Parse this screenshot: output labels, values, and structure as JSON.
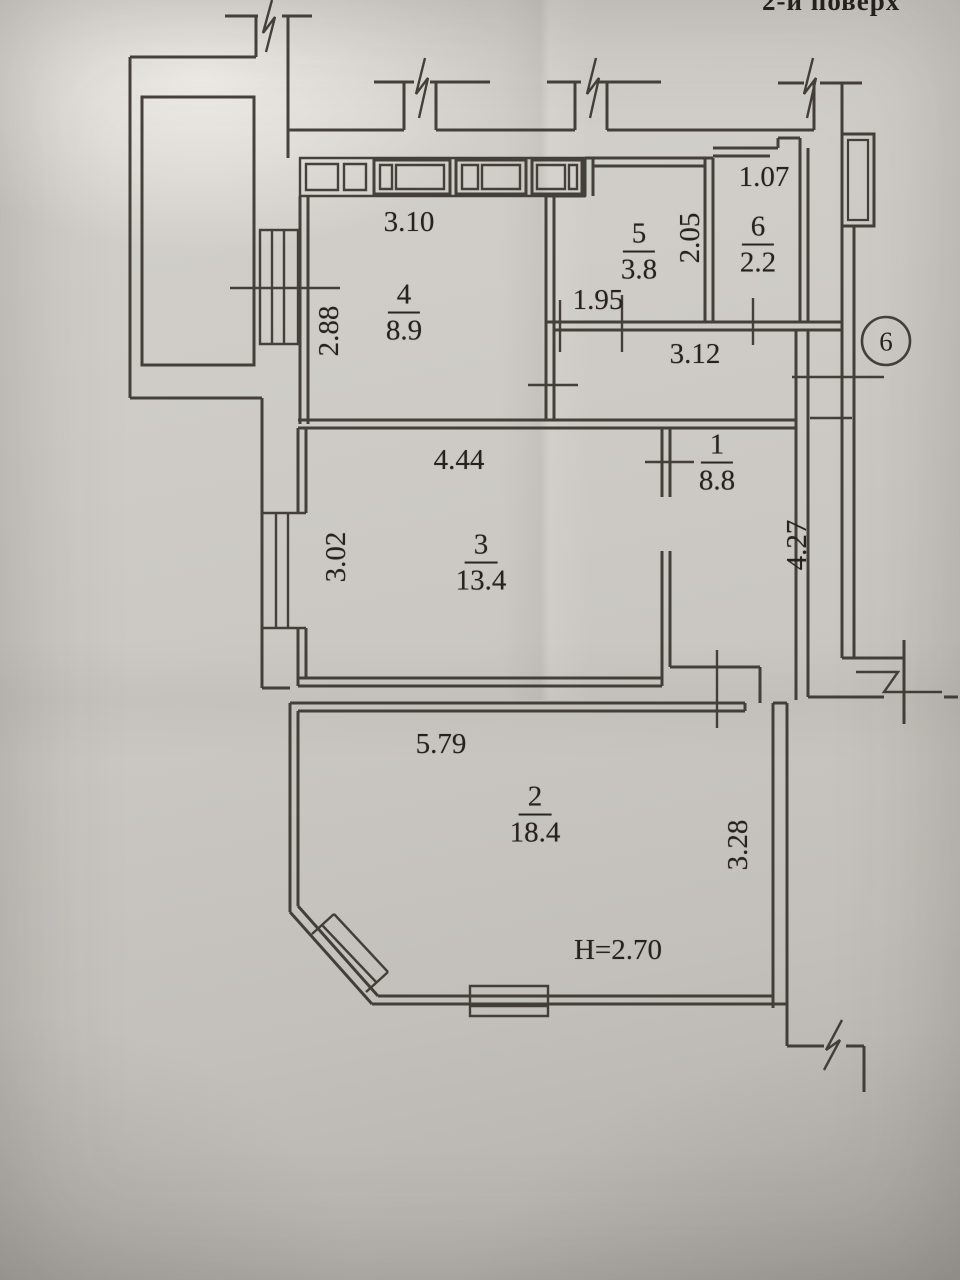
{
  "meta": {
    "floor_label": "2-й поверх"
  },
  "rooms": {
    "r1": {
      "number": "1",
      "area": "8.8"
    },
    "r2": {
      "number": "2",
      "area": "18.4"
    },
    "r3": {
      "number": "3",
      "area": "13.4"
    },
    "r4": {
      "number": "4",
      "area": "8.9"
    },
    "r5": {
      "number": "5",
      "area": "3.8"
    },
    "r6": {
      "number": "6",
      "area": "2.2"
    }
  },
  "dimensions": {
    "d310": "3.10",
    "d288": "2.88",
    "d195": "1.95",
    "d205": "2.05",
    "d107": "1.07",
    "d312": "3.12",
    "d444": "4.44",
    "d302": "3.02",
    "d427": "4.27",
    "d579": "5.79",
    "d328": "3.28",
    "height": "H=2.70"
  },
  "markers": {
    "axis_circle": "6"
  },
  "colors": {
    "ink": "#3a352f",
    "paper": "#cdcac5"
  }
}
